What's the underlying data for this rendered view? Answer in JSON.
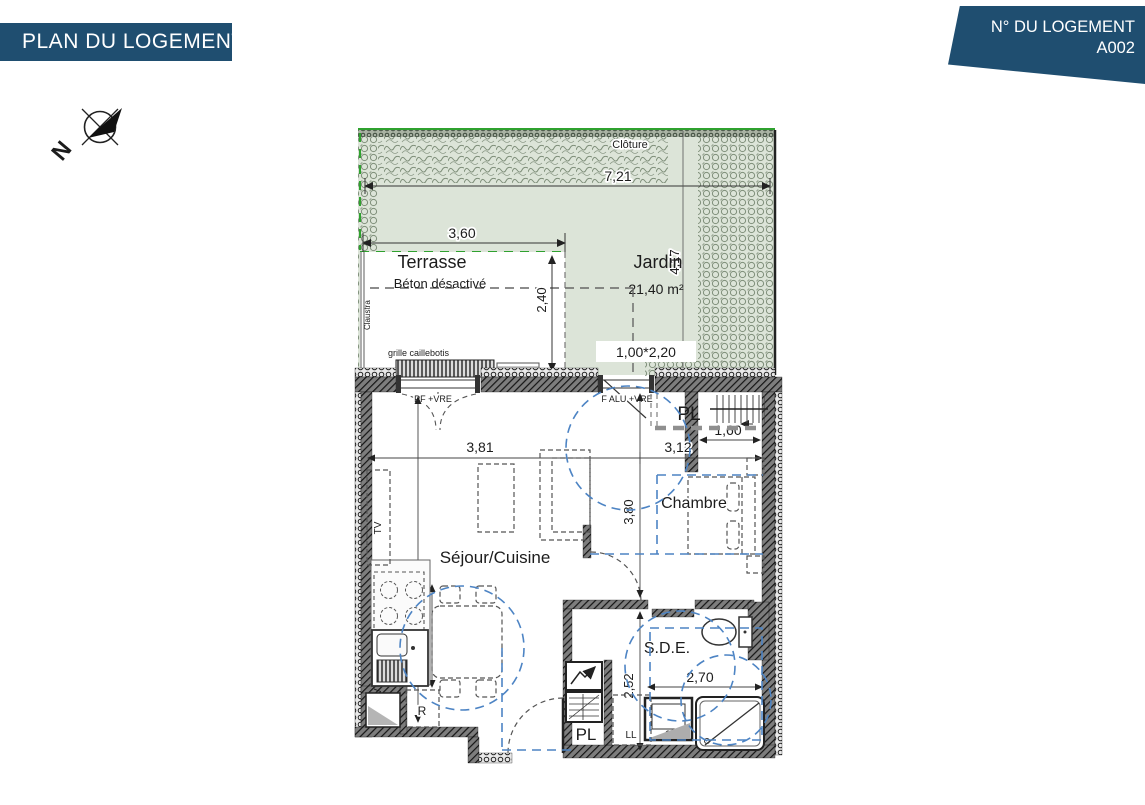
{
  "header": {
    "left_banner": "PLAN DU LOGEMENT",
    "right_banner_title": "N° DU LOGEMENT",
    "right_banner_number": "A002"
  },
  "compass": {
    "north_label": "N"
  },
  "colors": {
    "banner_blue": "#1f4e70",
    "garden_green": "#dce4d8",
    "vegetation_green": "#7e8e79",
    "fence_green": "#2fa12f",
    "accessibility_blue": "#4d84c4"
  },
  "garden": {
    "fence_label": "Clôture",
    "name": "Jardin",
    "area": "21,40 m²",
    "width_dim": "7,21",
    "depth_dim": "4,17",
    "gate_dim": "1,00*2,20"
  },
  "terrace": {
    "name": "Terrasse",
    "finish_label": "Béton désactivé",
    "width_dim": "3,60",
    "depth_dim": "2,40",
    "screen_label": "Claustra",
    "grate_label": "grille caillebotis"
  },
  "openings": {
    "living_door": "PF +VRE",
    "bedroom_window": "F ALU +VRE"
  },
  "rooms": {
    "living_kitchen": "Séjour/Cuisine",
    "bedroom": "Chambre",
    "shower_room": "S.D.E.",
    "closet_top": "PL",
    "closet_bottom": "PL"
  },
  "fixtures": {
    "tv": "TV",
    "dishwasher": "LV",
    "fridge": "R",
    "washing_machine": "LL"
  },
  "dimensions": {
    "living_width": "3,81",
    "bedroom_width": "3,12",
    "living_depth": "5,89",
    "kitchen_run": "1,80",
    "bedroom_depth": "3,80",
    "closet_width": "1,60",
    "shower_room_depth": "2,52",
    "shower_room_width": "2,70"
  }
}
